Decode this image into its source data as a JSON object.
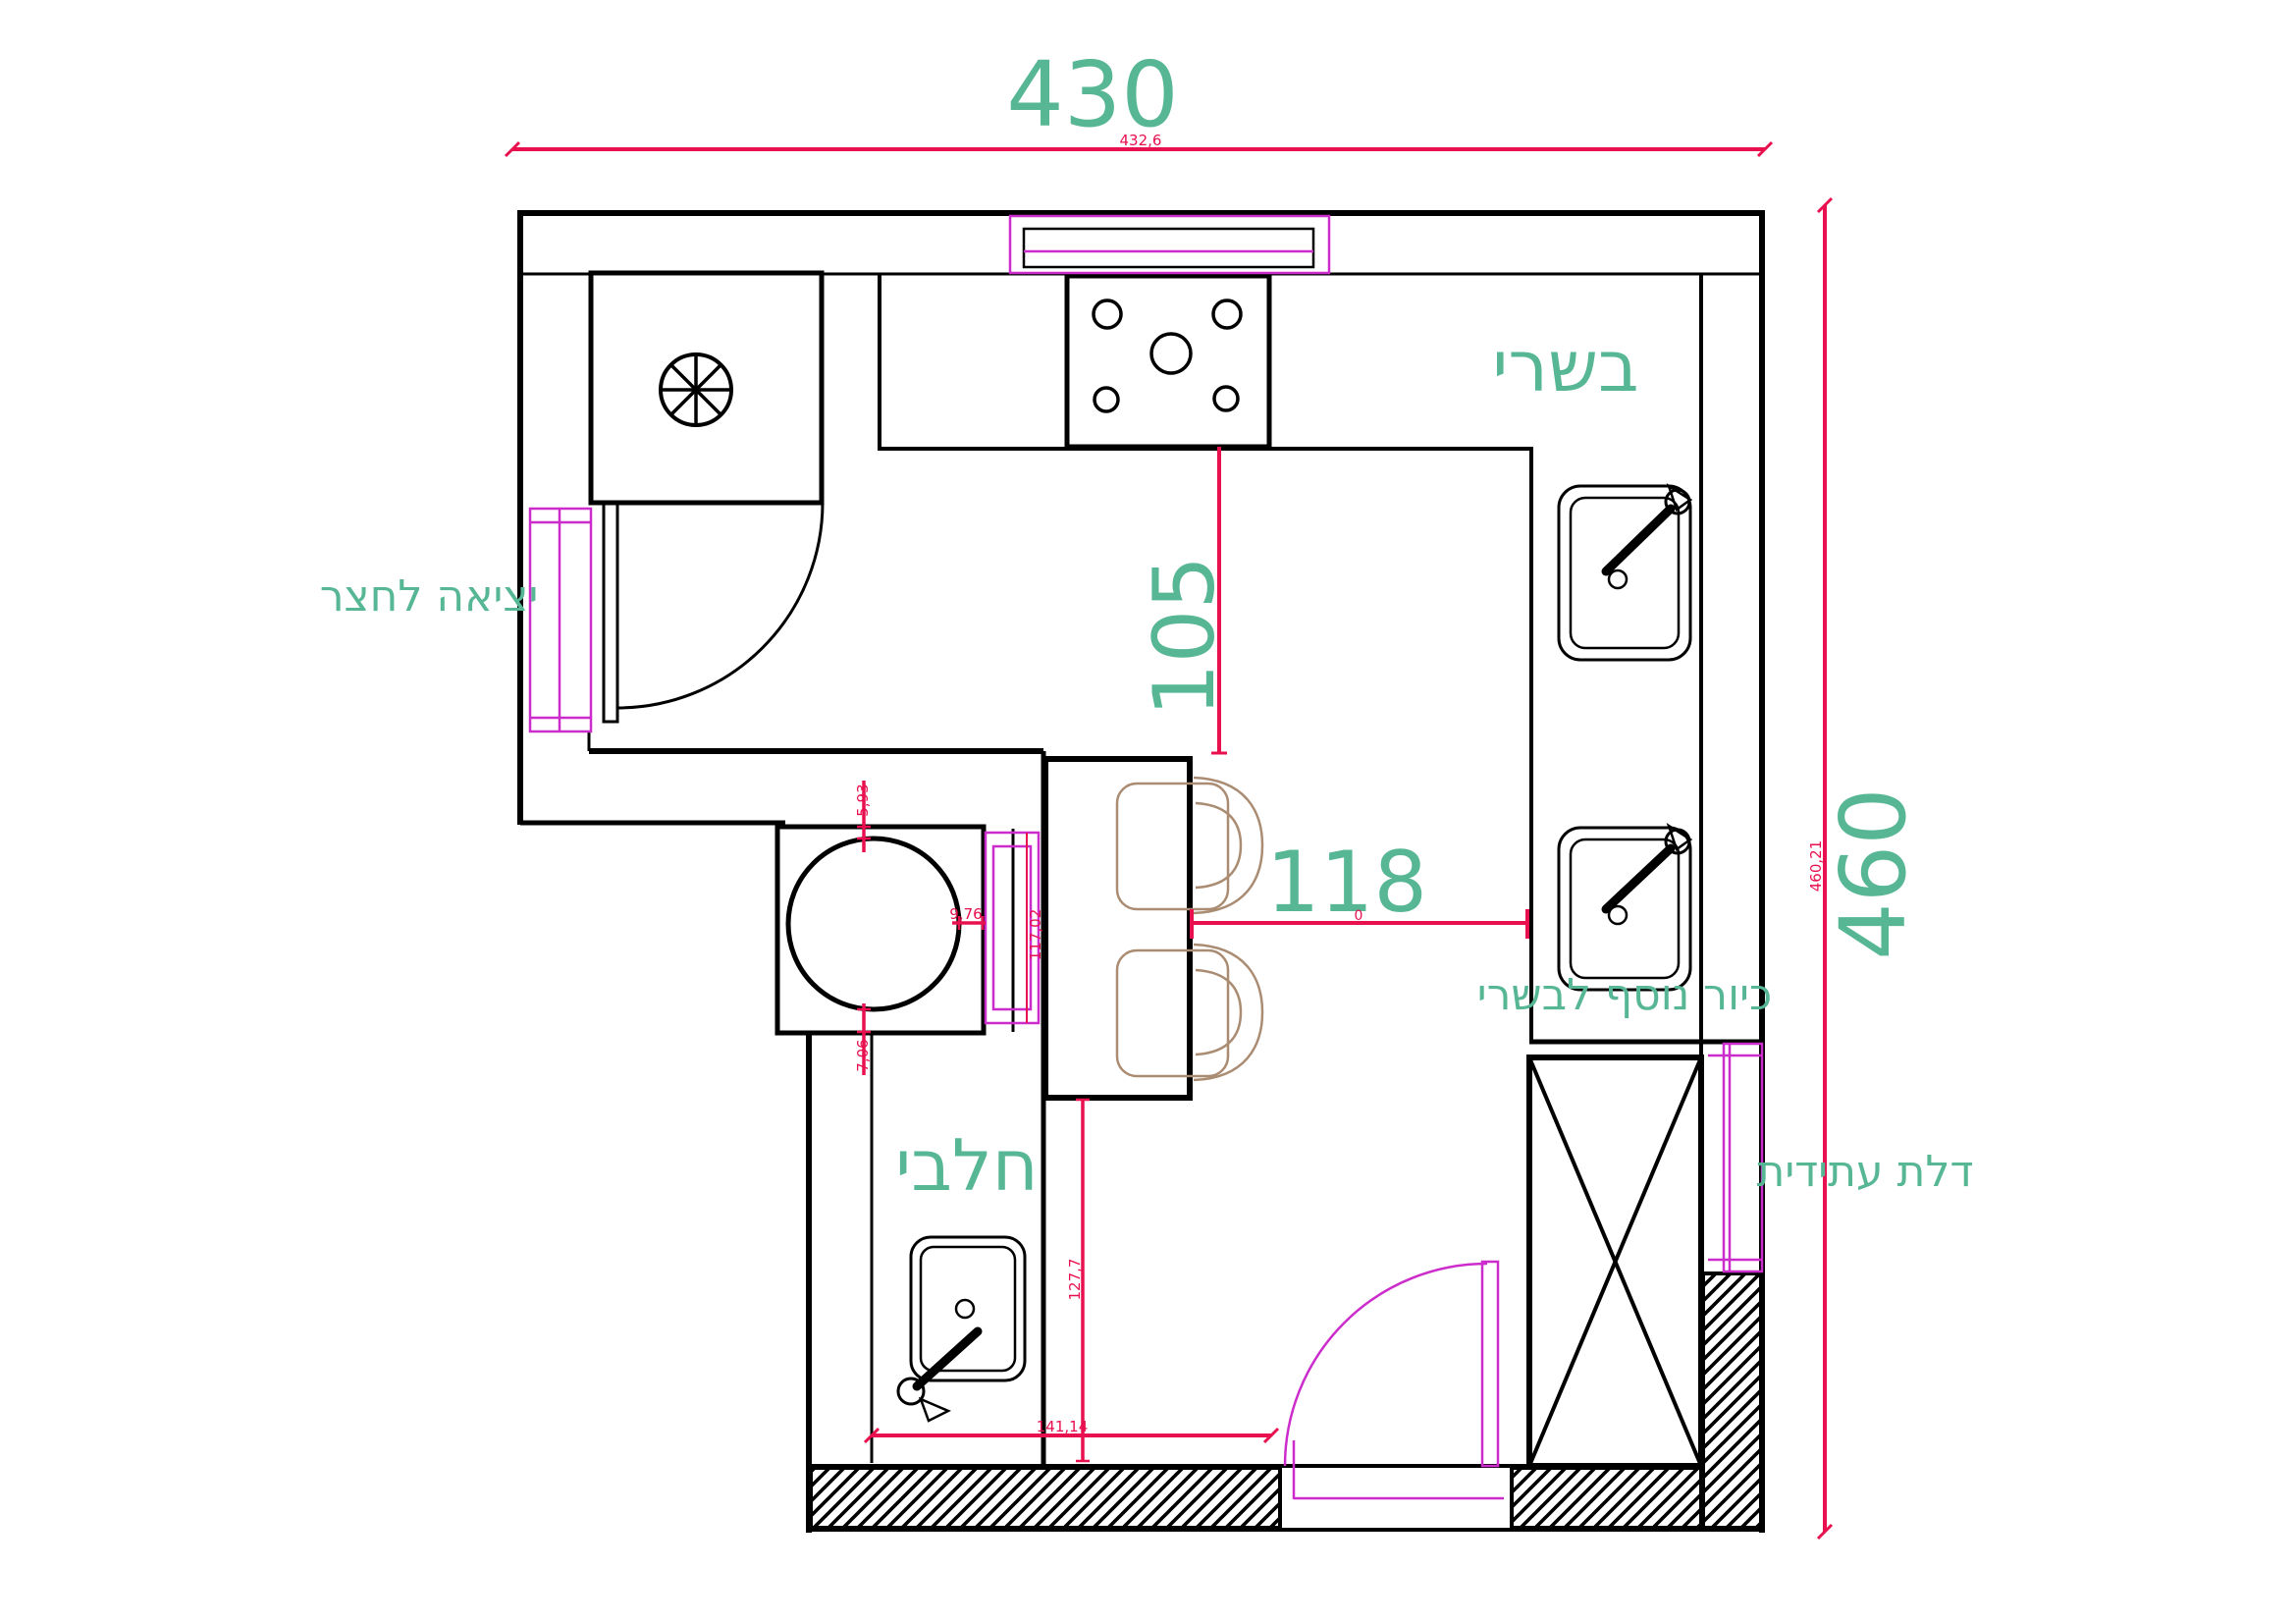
{
  "plan": {
    "type": "kitchen-floor-plan",
    "colors": {
      "label_teal": "#57b795",
      "dimension_red": "#e8104e",
      "fixture_magenta": "#cc2ccc",
      "chair_tan": "#aa8c73",
      "wall_black": "#000000"
    },
    "labels": {
      "meat_zone": "בשרי",
      "dairy_zone": "חלבי",
      "exit_to_yard": "יציאה לחצר",
      "extra_meat_sink": "כיור נוסף לבשרי",
      "future_door": "דלת עתידית"
    },
    "dimensions": {
      "total_width": "430",
      "total_width_exact": "432,6",
      "total_height": "460",
      "total_height_exact": "460,21",
      "stove_to_table": "105",
      "table_to_counter": "118",
      "table_to_counter_offset": "0",
      "gap_block_top": "5,93",
      "gap_block_right": "9,76",
      "gap_block_bottom": "7,06",
      "passage_length": "117,02",
      "table_to_bottom_wall": "127,7",
      "dairy_run_length": "141,14"
    }
  }
}
